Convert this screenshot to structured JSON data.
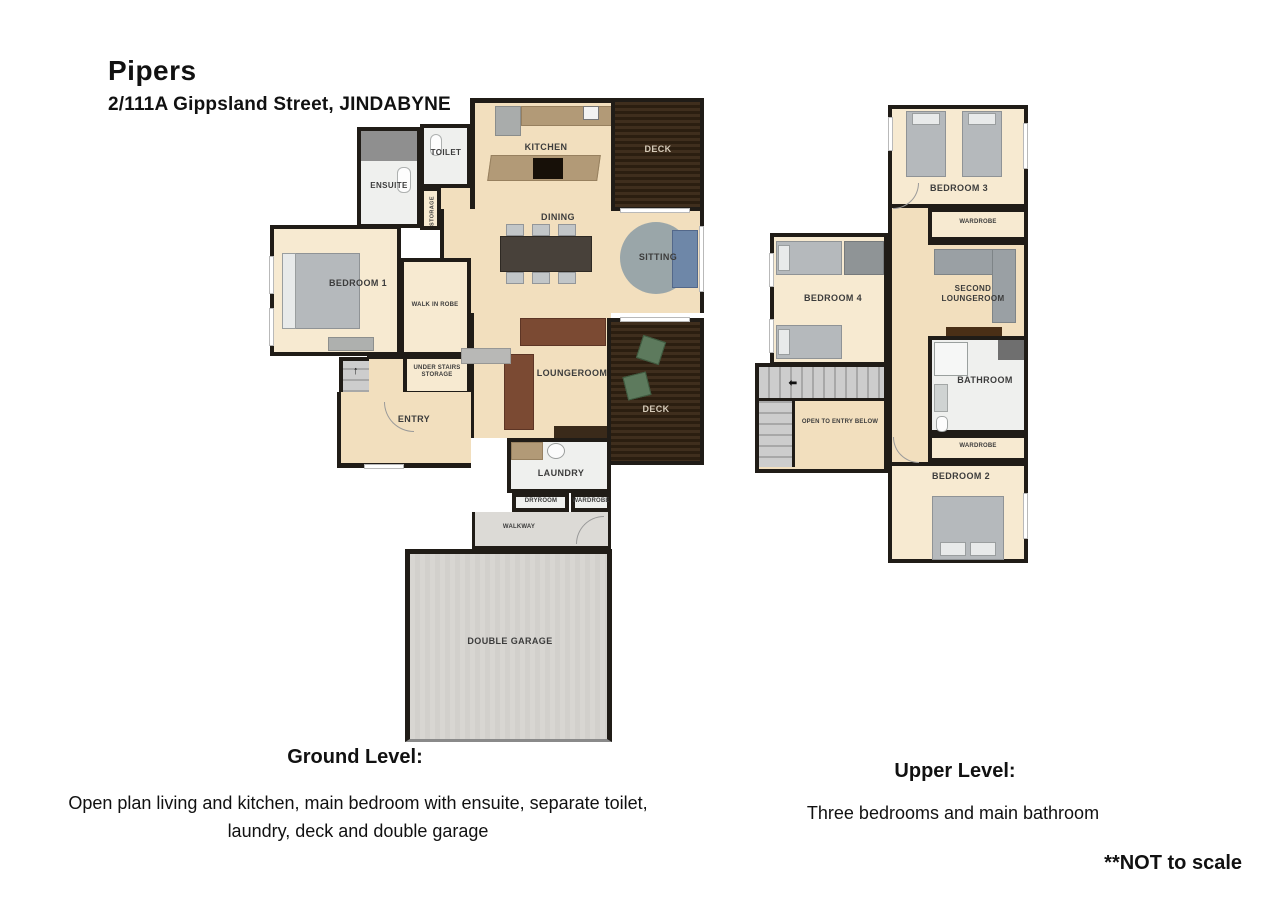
{
  "colors": {
    "wall": "#201c17",
    "floor": "#f2dfbe",
    "floor_light": "#f7ead1",
    "label": "#3c3c3c",
    "text": "#111111",
    "bed": "#b5b9bc",
    "sofa_brown": "#7b4a33",
    "sofa_blue": "#6e87a8",
    "rug": "#9aa6a9",
    "counter": "#b29a77",
    "chair_green": "#5d7a5d"
  },
  "header": {
    "title": "Pipers",
    "subtitle": "2/111A Gippsland Street, JINDABYNE"
  },
  "ground": {
    "rooms": {
      "ensuite": "ENSUITE",
      "toilet": "TOILET",
      "storage": "STORAGE",
      "kitchen": "KITCHEN",
      "deck_top": "DECK",
      "dining": "DINING",
      "sitting": "SITTING",
      "bedroom1": "BEDROOM 1",
      "walk_in_robe": "WALK IN ROBE",
      "under_stairs": "UNDER STAIRS STORAGE",
      "entry": "ENTRY",
      "loungeroom": "LOUNGEROOM",
      "deck_bottom": "DECK",
      "laundry": "LAUNDRY",
      "dryroom": "DRYROOM",
      "wardrobe": "WARDROBE",
      "walkway": "WALKWAY",
      "garage": "DOUBLE GARAGE"
    }
  },
  "upper": {
    "rooms": {
      "bedroom3": "BEDROOM 3",
      "wardrobe_top": "WARDROBE",
      "bedroom4": "BEDROOM 4",
      "second_loungeroom": "SECOND LOUNGEROOM",
      "bathroom": "BATHROOM",
      "open_to_entry": "OPEN TO ENTRY BELOW",
      "wardrobe_bottom": "WARDROBE",
      "bedroom2": "BEDROOM 2"
    }
  },
  "icons": {
    "up_arrow": "↑",
    "left_arrow": "⬅"
  },
  "captions": {
    "ground_heading": "Ground Level:",
    "ground_body": "Open plan living and kitchen, main bedroom with ensuite, separate toilet, laundry, deck and double garage",
    "upper_heading": "Upper Level:",
    "upper_body": "Three bedrooms and main bathroom",
    "disclaimer": "**NOT to scale"
  }
}
